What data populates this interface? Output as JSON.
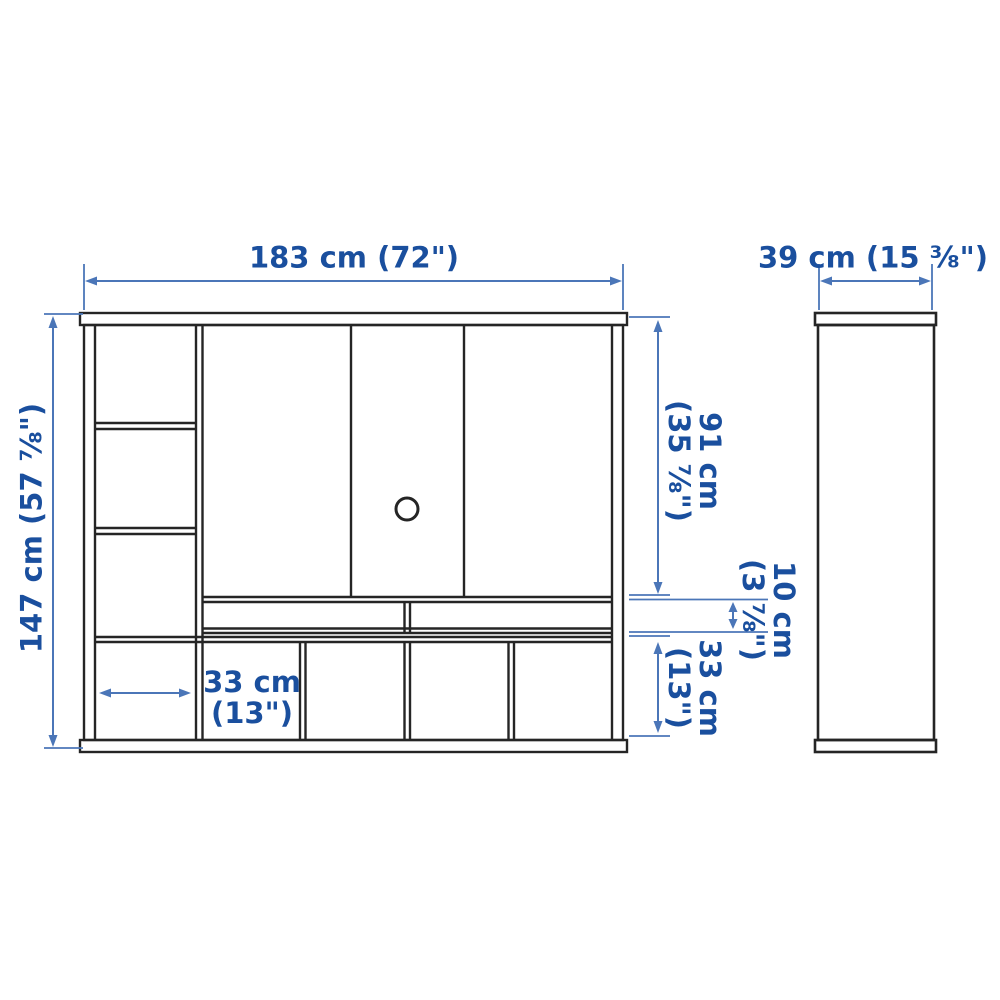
{
  "colors": {
    "dimension-text": "#1a4f9e",
    "dimension-line": "#4b76b8",
    "outline": "#252525",
    "background": "#ffffff"
  },
  "labels": {
    "width": "183 cm (72\")",
    "depth": "39 cm (15 ⅜\")",
    "height": "147 cm (57 ⅞\")",
    "upper_section": {
      "cm": "91 cm",
      "inch": "(35 ⅞\")"
    },
    "media_gap": {
      "cm": "10 cm",
      "inch": "(3 ⅞\")"
    },
    "lower_section": {
      "cm": "33 cm",
      "inch": "(13\")"
    },
    "cube_width": {
      "cm": "33 cm",
      "inch": "(13\")"
    }
  }
}
